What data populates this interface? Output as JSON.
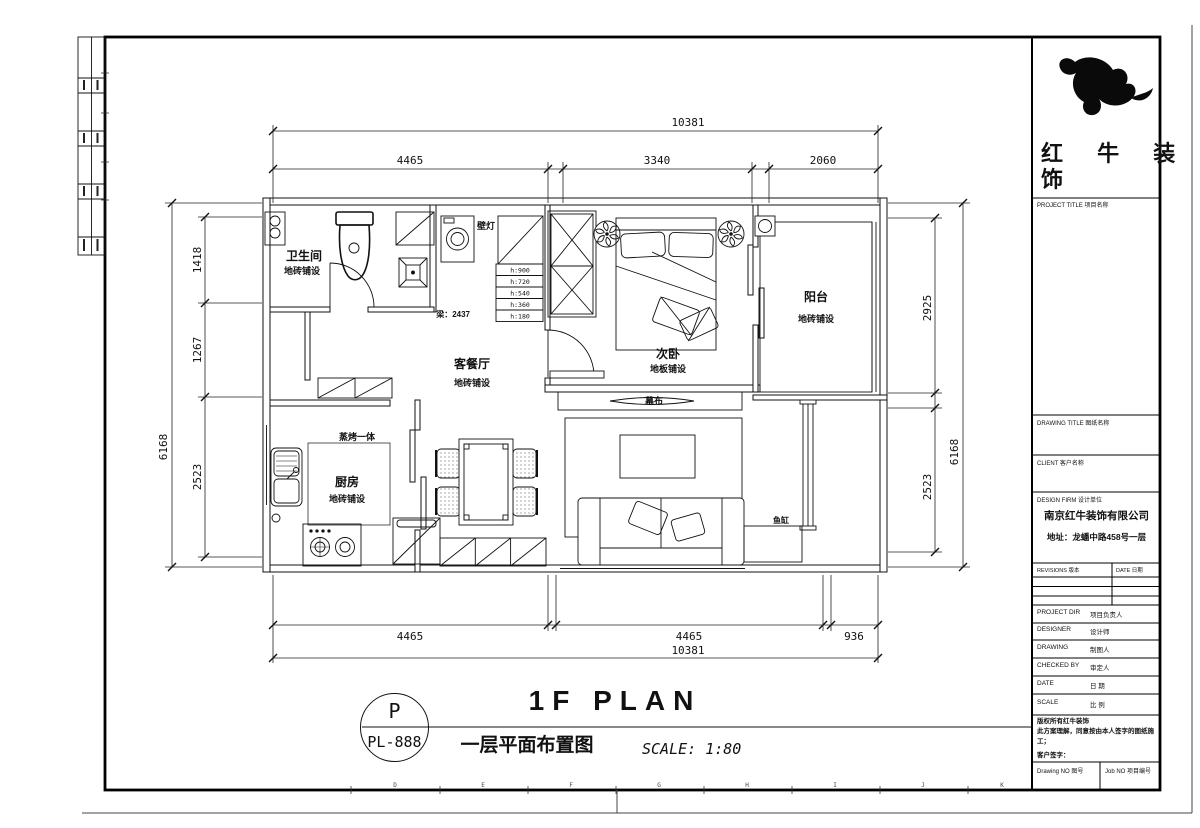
{
  "sheet": {
    "stamp_letter": "P",
    "stamp_code": "PL-888",
    "title_en": "1F PLAN",
    "title_cn": "一层平面布置图",
    "scale_note": "SCALE: 1:80",
    "grid_letters": [
      "D",
      "E",
      "F",
      "G",
      "H",
      "I",
      "J",
      "K"
    ]
  },
  "dims": {
    "top": {
      "overall": "10381",
      "segments": [
        "4465",
        "3340",
        "2060"
      ]
    },
    "bottom": {
      "overall": "10381",
      "segments": [
        "4465",
        "4465",
        "936"
      ]
    },
    "left": {
      "overall": "6168",
      "segments": [
        "1418",
        "1267",
        "2523"
      ]
    },
    "right": {
      "overall": "6168",
      "segments": [
        "2925",
        "2523"
      ]
    }
  },
  "rooms": {
    "bathroom": {
      "name": "卫生间",
      "floor": "地砖铺设"
    },
    "living": {
      "name": "客餐厅",
      "floor": "地砖铺设"
    },
    "bedroom": {
      "name": "次卧",
      "floor": "地板铺设"
    },
    "balcony": {
      "name": "阳台",
      "floor": "地砖铺设"
    },
    "kitchen": {
      "name": "厨房",
      "floor": "地砖铺设"
    }
  },
  "annotations": {
    "wall_lamp": "壁灯",
    "beam": "梁：2437",
    "steam_oven": "蒸烤一体",
    "screen": "幕布",
    "fish_tank": "鱼缸",
    "heights": [
      "h:900",
      "h:720",
      "h:540",
      "h:360",
      "h:180"
    ]
  },
  "titleblock": {
    "brand_line1": "红 牛 装",
    "brand_line2": "饰",
    "project_title": "PROJECT TITLE 项目名称",
    "drawing_title": "DRAWING TITLE 图纸名称",
    "client": "CLIENT 客户名称",
    "design_firm": "DESIGN FIRM 设计单位",
    "firm_name": "南京红牛装饰有限公司",
    "firm_address": "地址：龙蟠中路458号一层",
    "revisions": "REVISIONS 版本",
    "date_header": "DATE 日期",
    "rows": [
      {
        "en": "PROJECT DIR",
        "cn": "项目负责人"
      },
      {
        "en": "DESIGNER",
        "cn": "设计师"
      },
      {
        "en": "DRAWING",
        "cn": "制图人"
      },
      {
        "en": "CHECKED BY",
        "cn": "审定人"
      },
      {
        "en": "DATE",
        "cn": "日 期"
      },
      {
        "en": "SCALE",
        "cn": "比 例"
      }
    ],
    "note1": "版权所有红牛装饰",
    "note2": "此方案理解，同意按由本人签字的图纸施工；",
    "note3": "客户签字：",
    "drawing_no": "Drawing NO 图号",
    "job_no": "Job NO 项目编号"
  }
}
